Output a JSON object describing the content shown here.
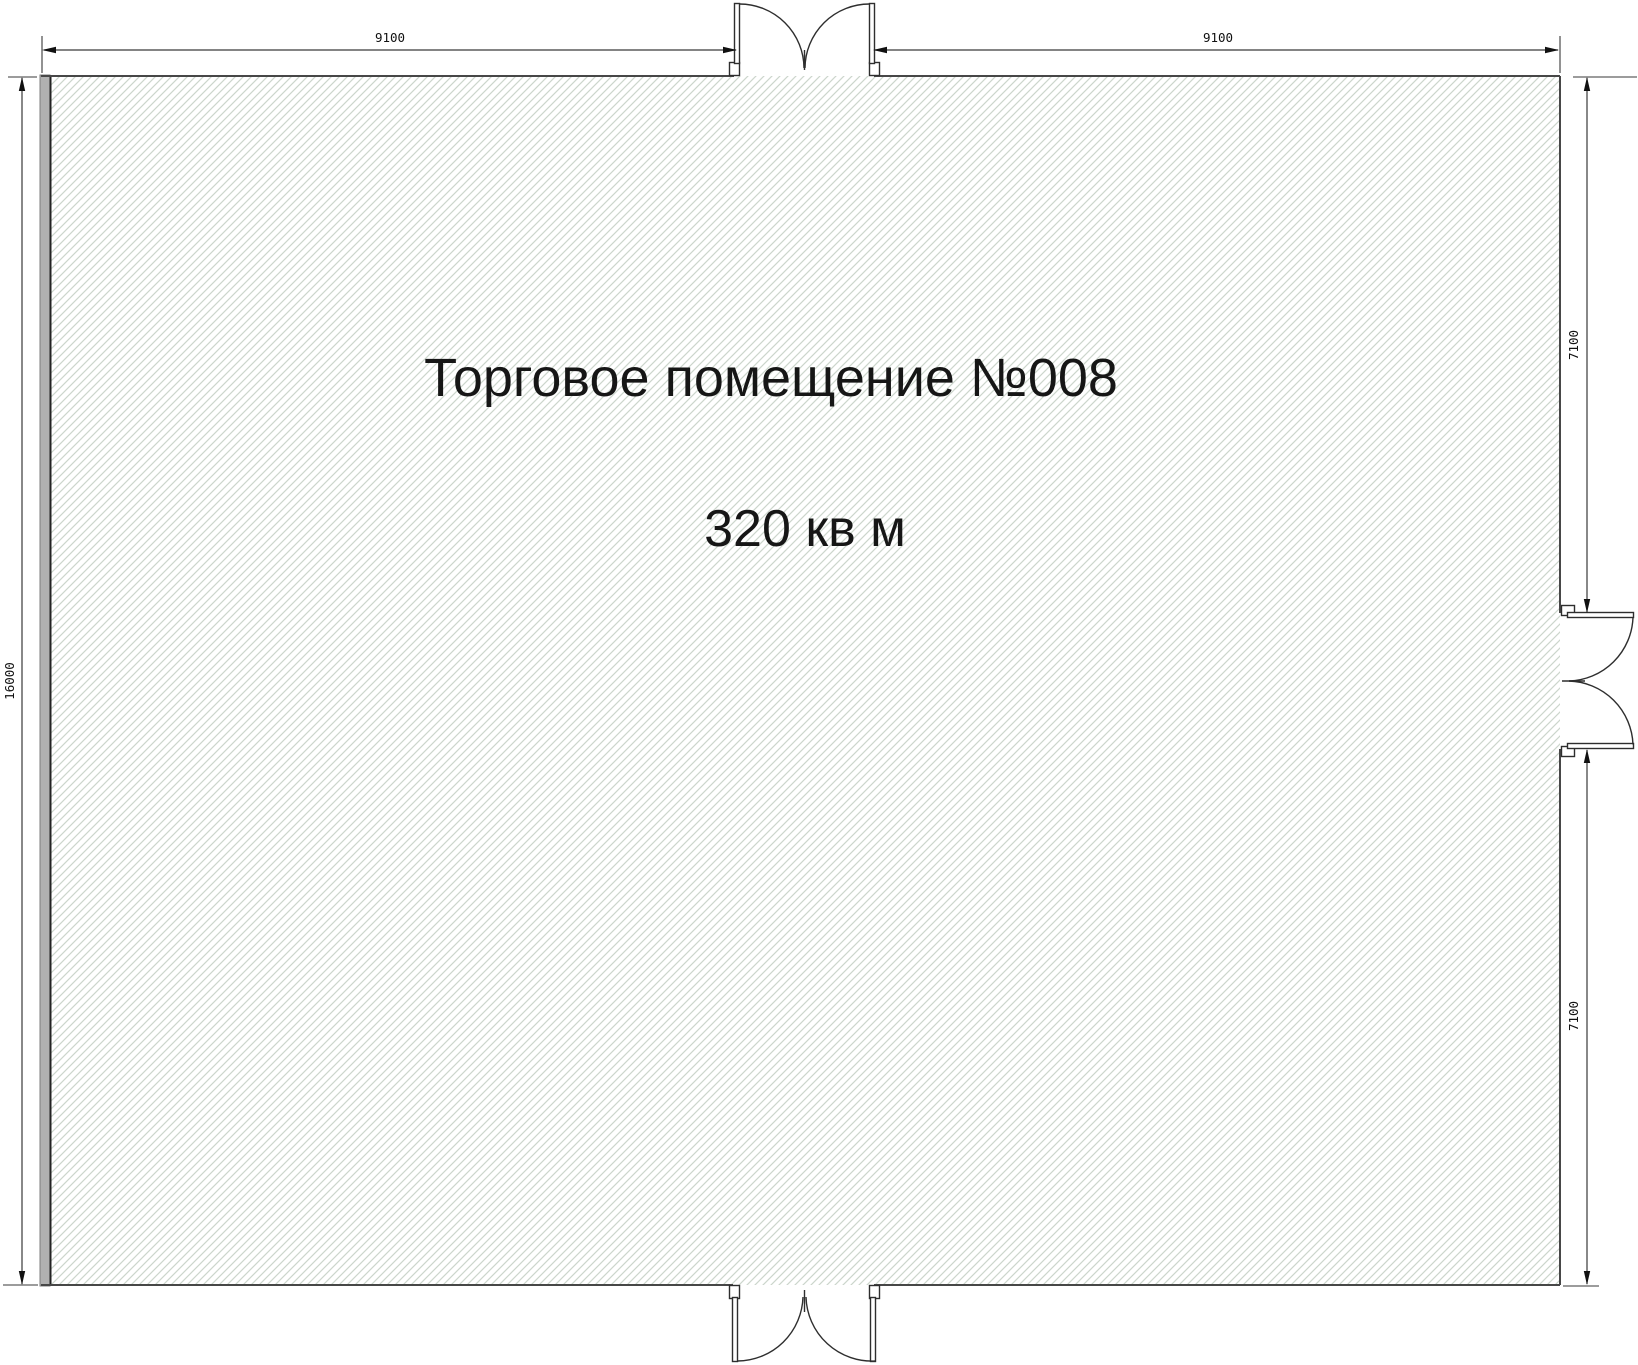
{
  "drawing": {
    "room_label": {
      "title": "Торговое помещение №008",
      "area": "320 кв м"
    },
    "dimensions": {
      "top_left": "9100",
      "top_right": "9100",
      "left": "16000",
      "right_upper": "7100",
      "right_lower": "7100"
    },
    "colors": {
      "hatch": "#ccd6cc",
      "wall_fill": "#b1b1b1",
      "outline": "#474747",
      "dimension_line": "#3a3a3a",
      "label_text": "#161616"
    }
  }
}
